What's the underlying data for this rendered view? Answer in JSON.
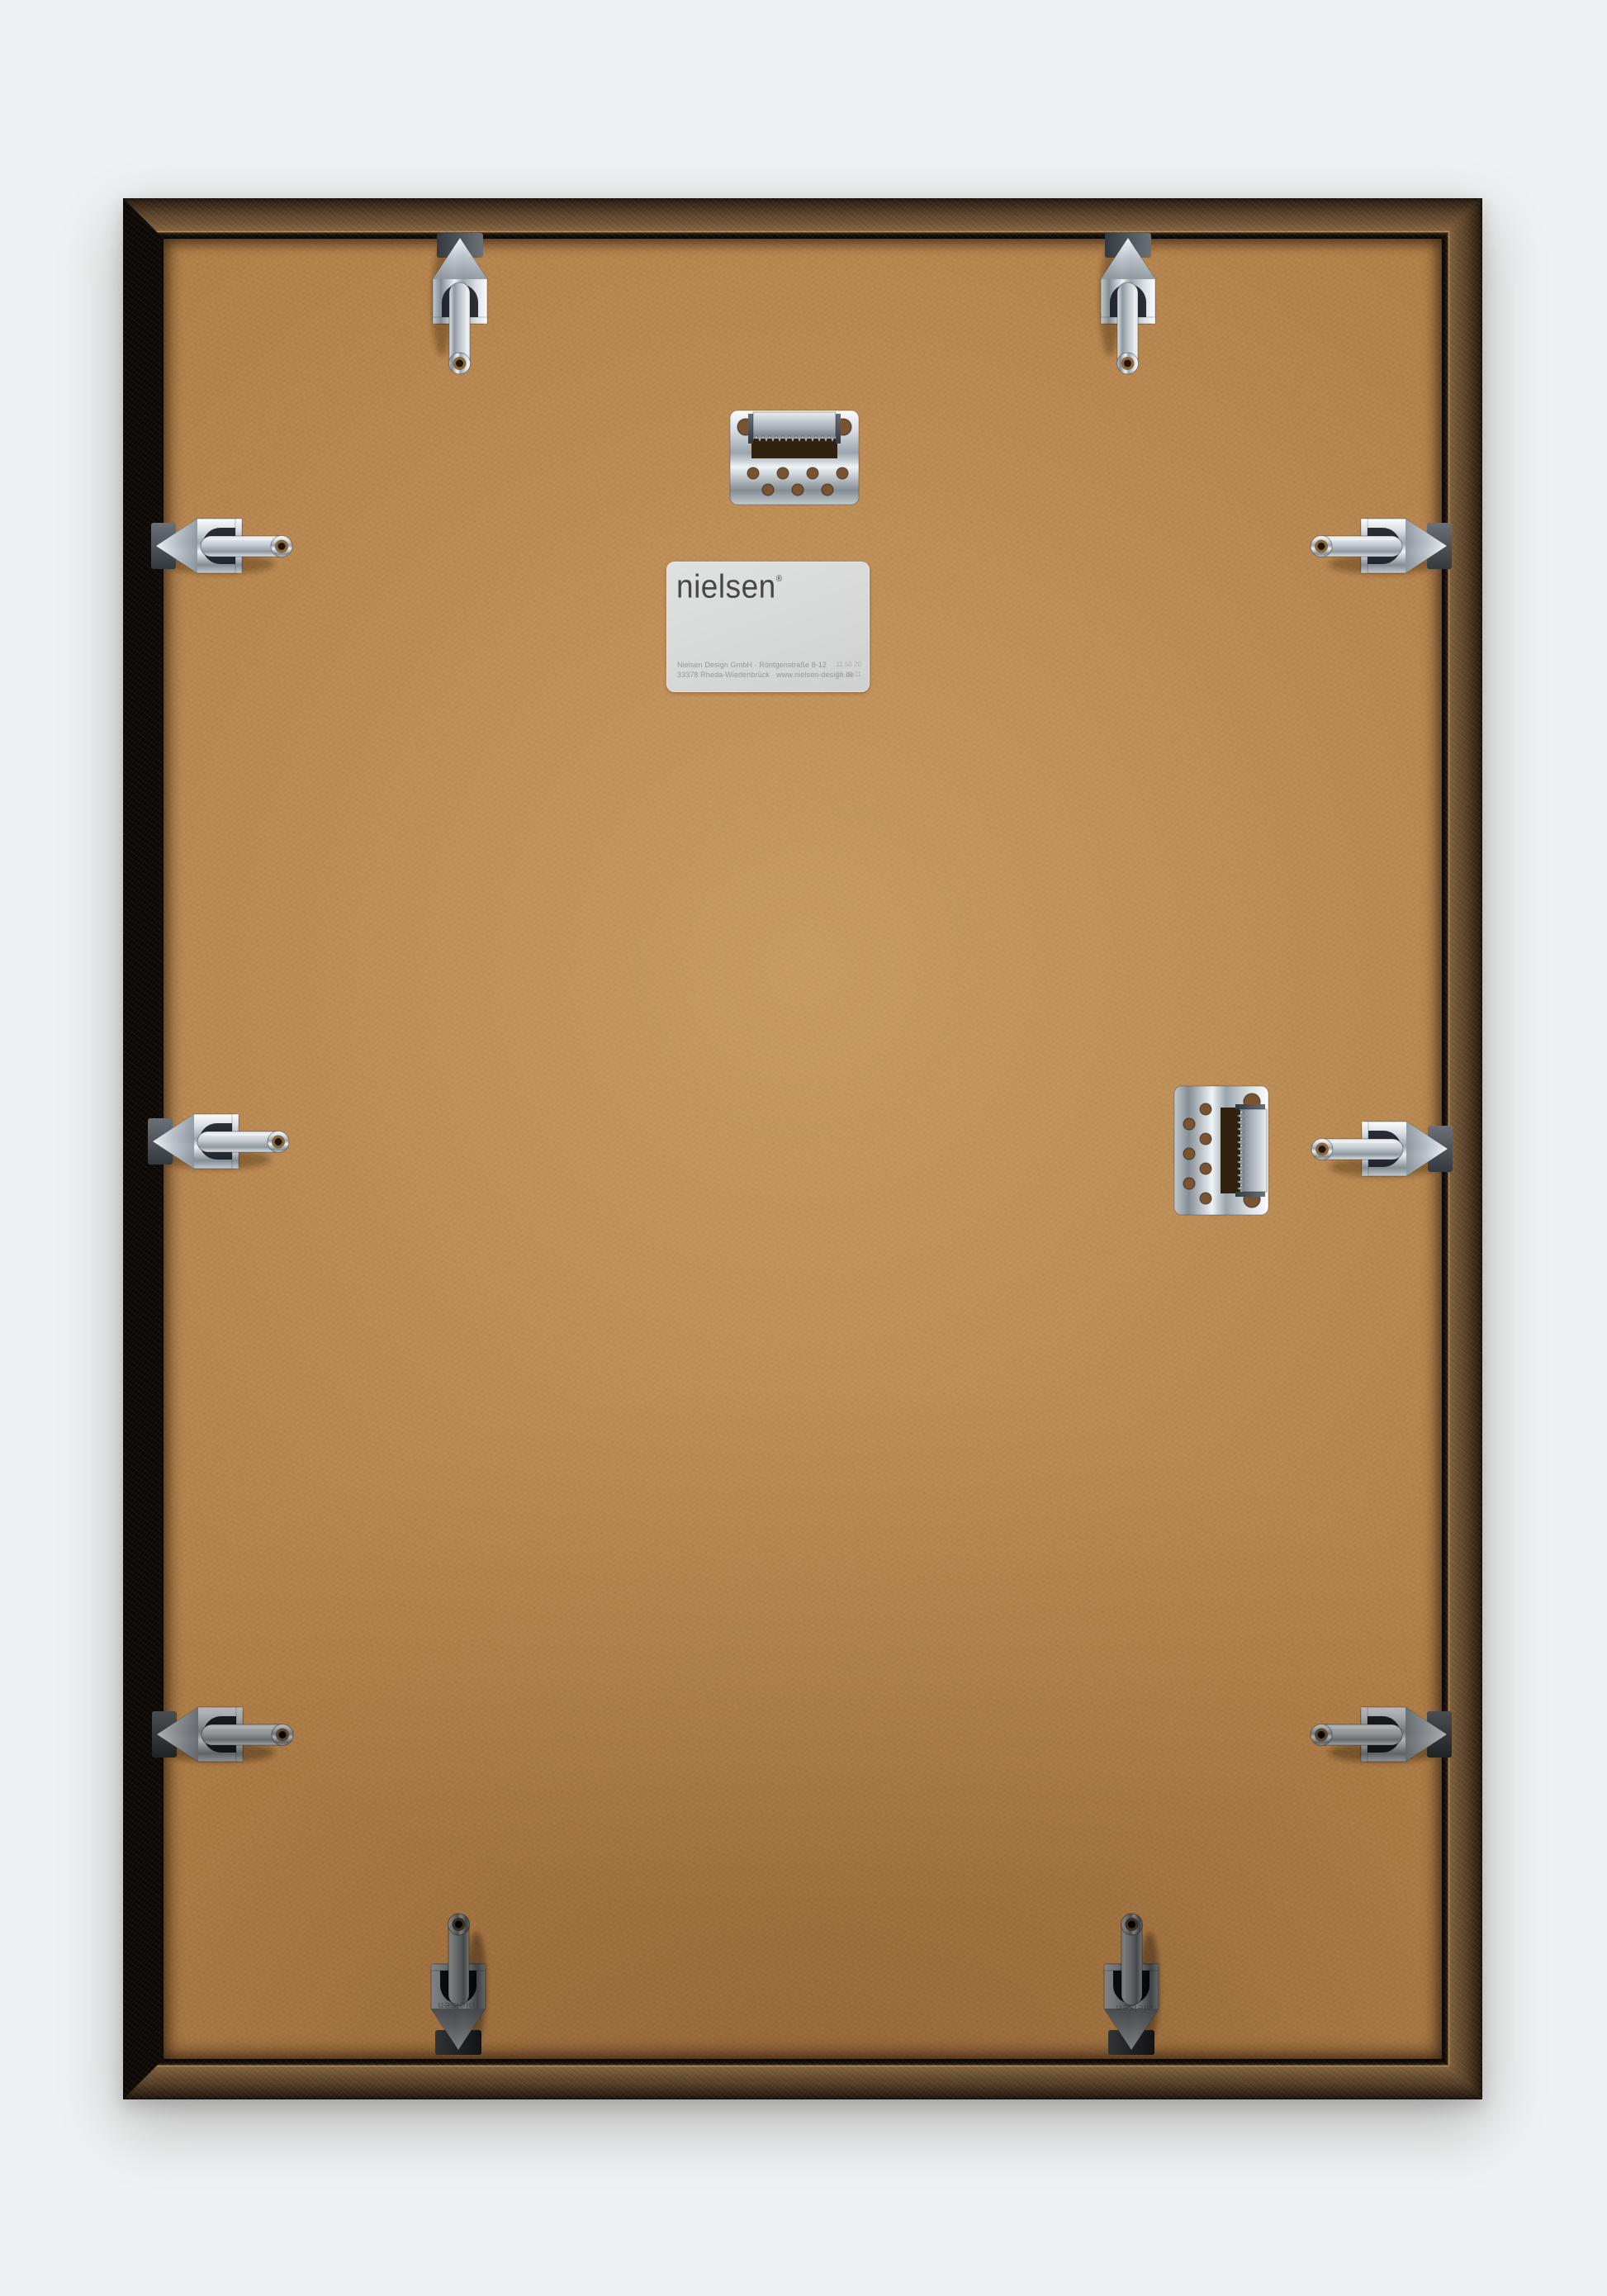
{
  "scene": {
    "description": "Back view of a nielsen picture frame with MDF backing, chrome spring clips and sawtooth hangers",
    "background_color": "#eef0f1",
    "moulding_color": "#6d5133",
    "backing_color": "#b28049",
    "chrome_color": "#d7dde2",
    "dark_clip_color": "#565b60"
  },
  "label": {
    "brand": "nielsen",
    "registered_mark": "®",
    "address_line1": "Nielsen Design GmbH · Röntgenstraße 8-12",
    "address_line2": "33378 Rheda-Wiedenbrück · www.nielsen-design.de",
    "code_line1": "11 50 20",
    "code_line2": "21 10 11"
  },
  "hardware": {
    "clip_embossing": "nielsen",
    "spring_clip_count": 10,
    "sawtooth_hanger_count": 2,
    "icons": {
      "spring_clip": "spring-clip-icon",
      "sawtooth_hanger": "sawtooth-hanger-icon"
    }
  }
}
